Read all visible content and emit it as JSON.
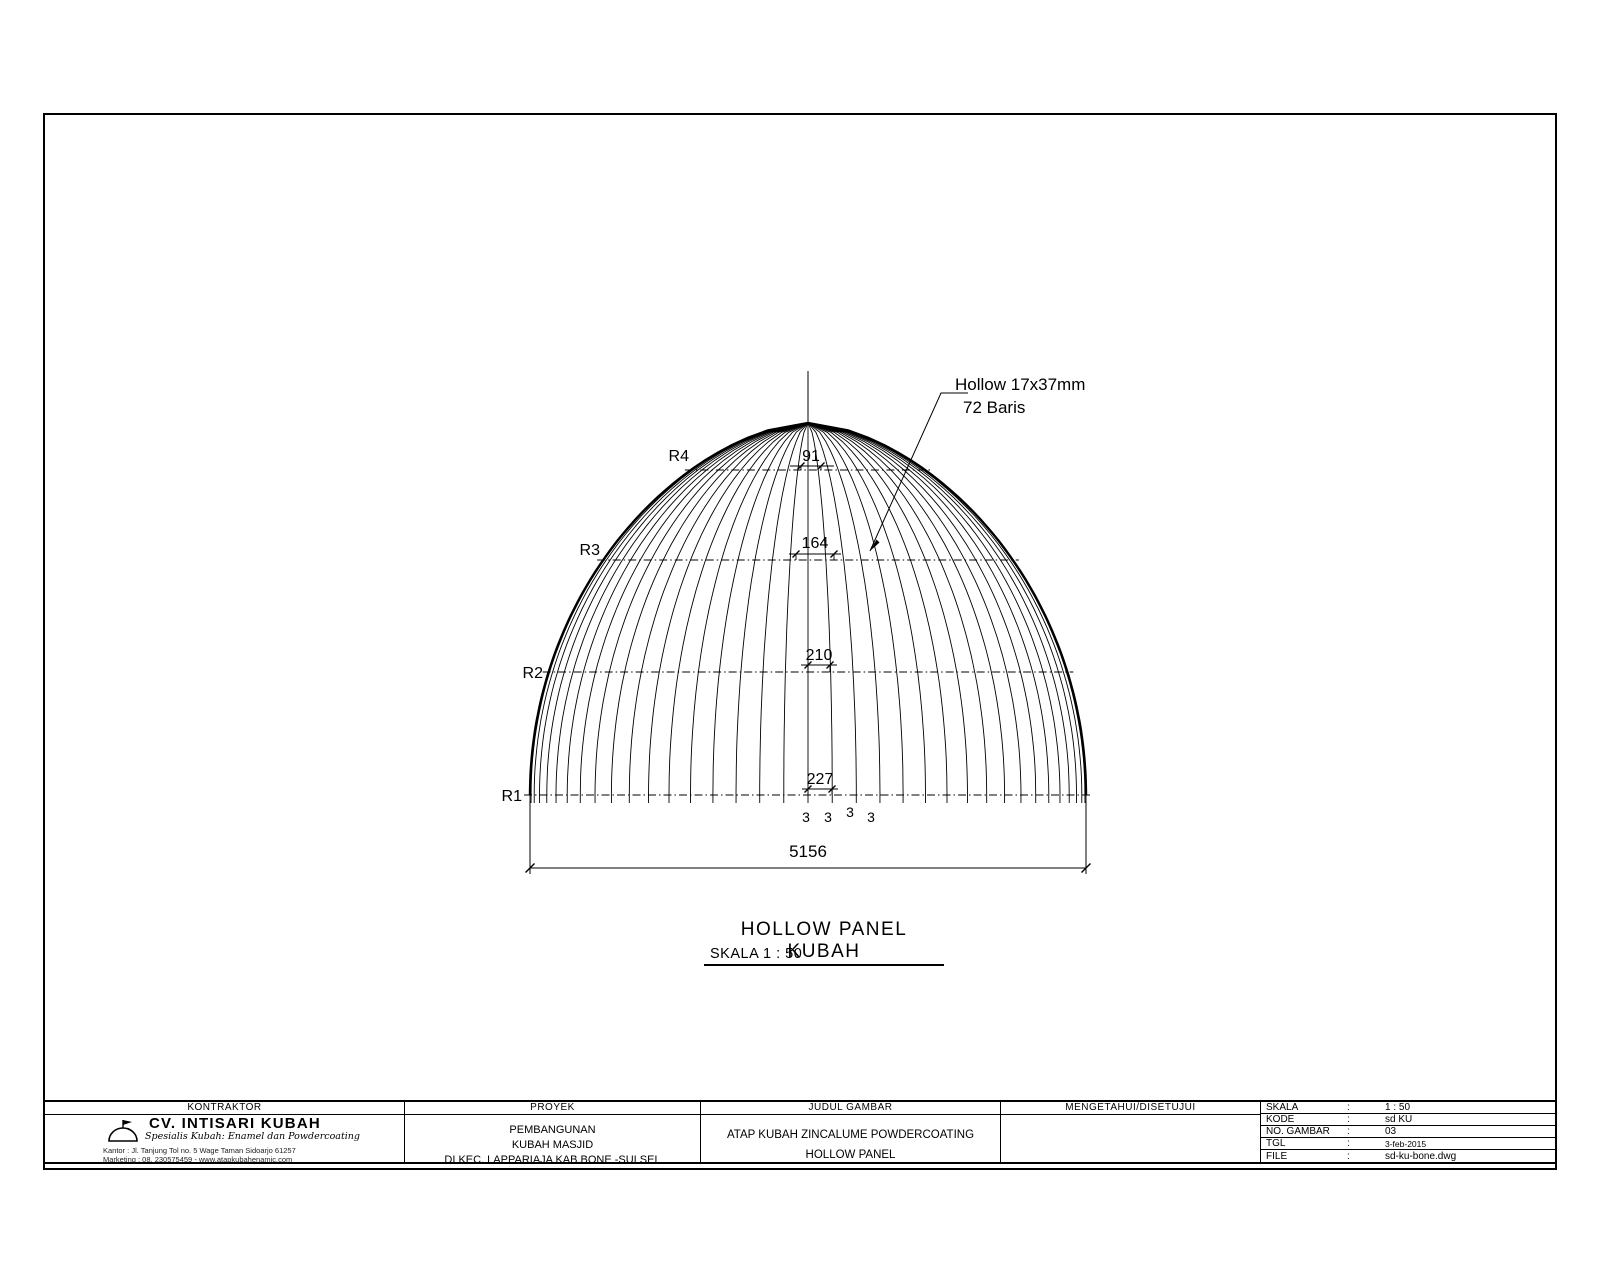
{
  "colors": {
    "line": "#000000",
    "background": "#ffffff"
  },
  "drawing": {
    "callout": {
      "line1": "Hollow 17x37mm",
      "line2": "72 Baris"
    },
    "rings": [
      {
        "label": "R1",
        "dim": "227"
      },
      {
        "label": "R2",
        "dim": "210"
      },
      {
        "label": "R3",
        "dim": "164"
      },
      {
        "label": "R4",
        "dim": "91"
      }
    ],
    "base_spacing_labels": [
      "3",
      "3",
      "3",
      "3"
    ],
    "overall_dim": "5156",
    "caption": {
      "title": "HOLLOW PANEL KUBAH",
      "scale": "SKALA 1 : 50"
    }
  },
  "title_block": {
    "kontraktor": {
      "header": "KONTRAKTOR",
      "company": "CV. INTISARI KUBAH",
      "tagline": "Spesialis Kubah: Enamel dan Powdercoating",
      "address": "Kantor : Jl. Tanjung Tol no. 5 Wage Taman Sidoarjo 61257",
      "marketing": "Marketing : 08. 230575459 - www.atapkubahenamic.com"
    },
    "proyek": {
      "header": "PROYEK",
      "lines": [
        "PEMBANGUNAN",
        "KUBAH MASJID",
        "DI KEC. LAPPARIAJA KAB.BONE -SULSEL"
      ]
    },
    "judul_gambar": {
      "header": "JUDUL GAMBAR",
      "lines": [
        "ATAP KUBAH ZINCALUME POWDERCOATING",
        "HOLLOW PANEL"
      ]
    },
    "mengetahui": {
      "header": "MENGETAHUI/DISETUJUI"
    },
    "info": {
      "rows": [
        {
          "label": "SKALA",
          "colon": ":",
          "value": "1 : 50"
        },
        {
          "label": "KODE",
          "colon": ":",
          "value": "sd KU"
        },
        {
          "label": "NO. GAMBAR",
          "colon": ":",
          "value": "03"
        },
        {
          "label": "TGL",
          "colon": ":",
          "value": "3-feb-2015"
        },
        {
          "label": "FILE",
          "colon": ":",
          "value": "sd-ku-bone.dwg"
        }
      ]
    }
  }
}
